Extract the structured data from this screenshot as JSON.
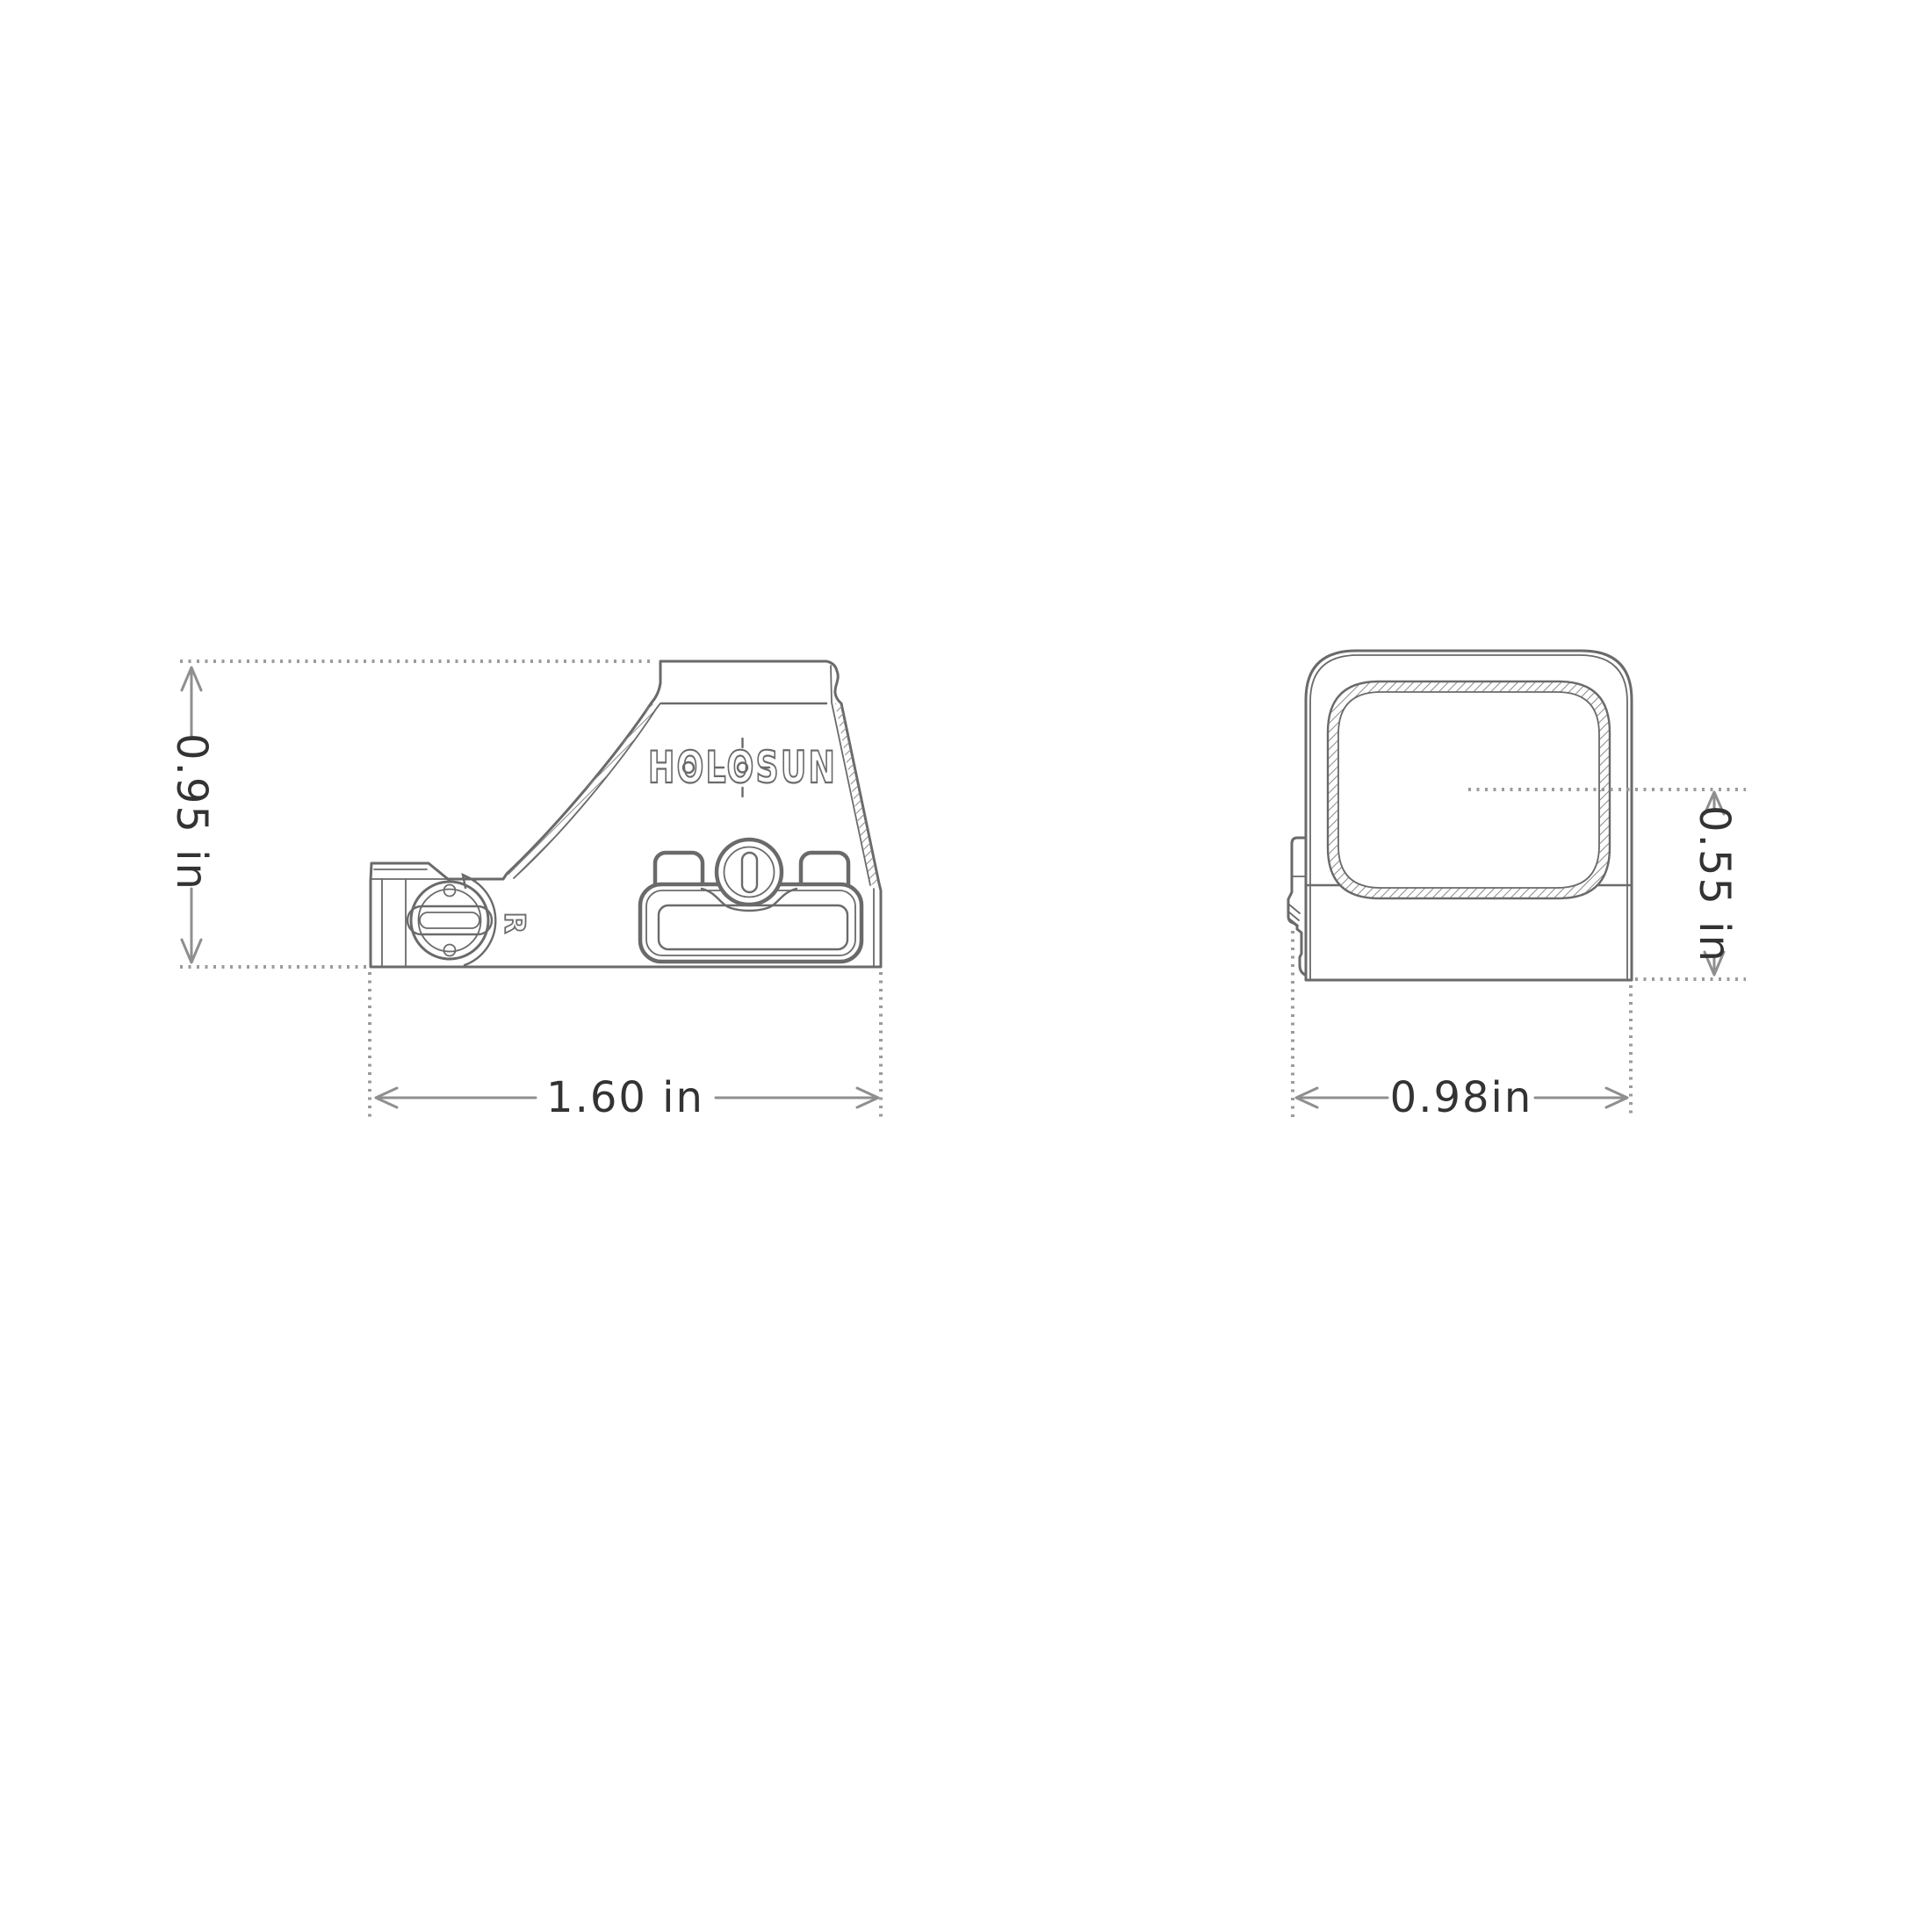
{
  "diagram": {
    "kind": "technical-dimension-drawing",
    "subject": "reflex red dot sight, side and front orthographic views"
  },
  "side_view": {
    "logo": "HOLOSUN",
    "dial_label": "R",
    "height_label": "0.95 in",
    "length_label": "1.60 in"
  },
  "front_view": {
    "window_height_label": "0.55 in",
    "width_label": "0.98in"
  },
  "colors": {
    "background": "#ffffff",
    "outline": "#6a6a6a",
    "dimension_lines": "#8f8f8f",
    "dotted_extension_lines": "#9b9b9b",
    "dimension_text": "#333333"
  }
}
